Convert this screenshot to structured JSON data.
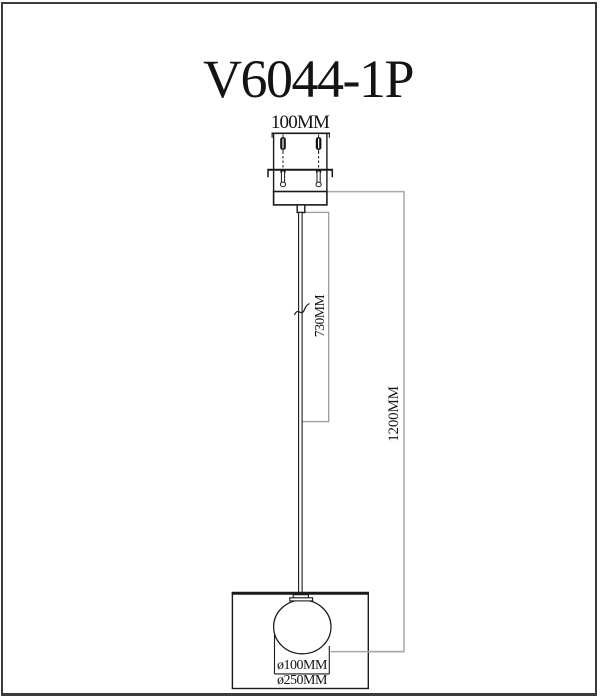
{
  "title": "V6044-1P",
  "dimensions": {
    "mount_width": "100MM",
    "rod_length": "730MM",
    "overall_height": "1200MM",
    "globe_diameter": "ø100MM",
    "shade_diameter": "ø250MM"
  },
  "colors": {
    "line": "#1a1a1a",
    "dim_line": "#9c9c9c",
    "light_dim_line": "#a9a9a9",
    "frame": "#3b3b3b",
    "background": "#ffffff"
  }
}
